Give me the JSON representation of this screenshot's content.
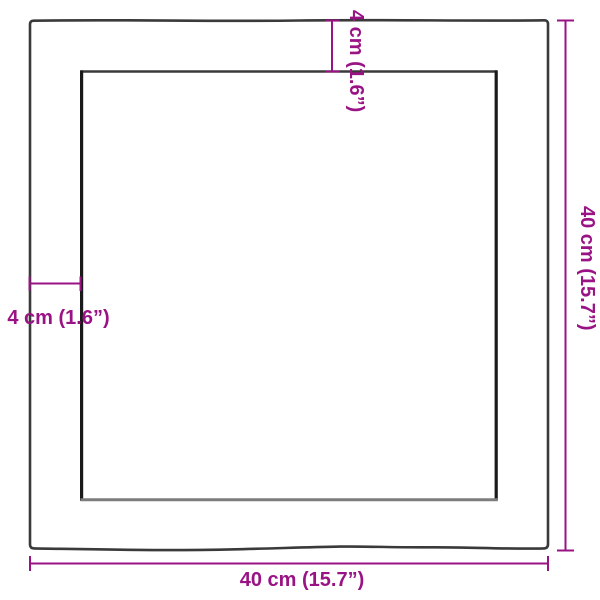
{
  "diagram_title": "square-board-dimensions",
  "dimensions": {
    "thickness_top": "4 cm (1.6”)",
    "thickness_left": "4 cm (1.6”)",
    "length_right": "40 cm (15.7”)",
    "width_bottom": "40 cm (15.7”)"
  },
  "colors": {
    "dimension": "#9a1385",
    "board_outline": "#3a3a3a",
    "board_inner_side": "#1a1a1a",
    "board_inner_bottom": "#7d7d7d",
    "background": "#ffffff"
  }
}
